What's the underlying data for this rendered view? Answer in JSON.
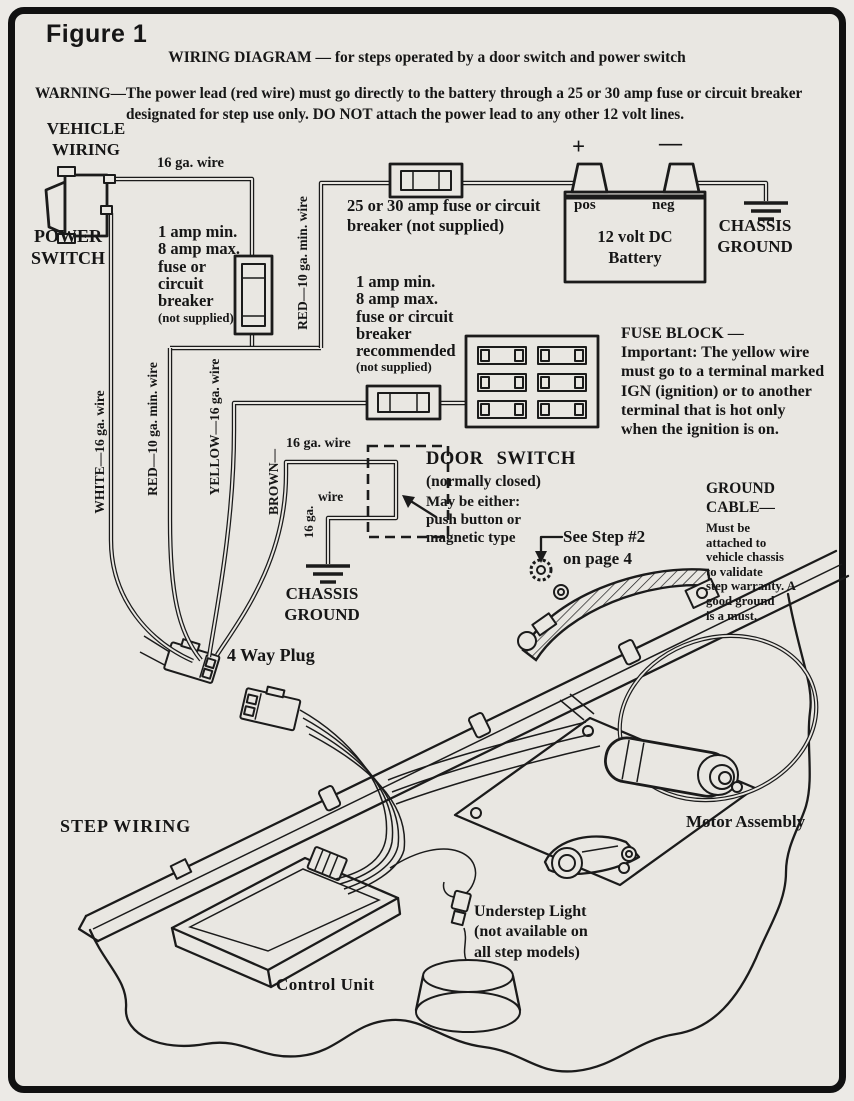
{
  "page": {
    "figure_label": "Figure 1",
    "title": "WIRING DIAGRAM — for steps operated by a door switch and power switch",
    "warning_line1": "WARNING—The power lead (red wire) must go directly to the battery through a 25 or 30 amp fuse or circuit breaker",
    "warning_line2": "designated for step use only.  DO NOT attach the power lead to any other 12 volt lines."
  },
  "vehicle_wiring": {
    "section_label": "VEHICLE\nWIRING",
    "power_switch": "POWER\nSWITCH",
    "wire_16ga_top": "16 ga. wire",
    "inline_fuse_1": {
      "spec": "1 amp min.\n8 amp max.\nfuse or\ncircuit\nbreaker",
      "note": "(not supplied)"
    },
    "red_wire_vertical": "RED—10 ga. min. wire",
    "main_fuse_label": "25 or 30 amp fuse or circuit\nbreaker (not supplied)",
    "battery": {
      "plus": "+",
      "minus": "—",
      "pos": "pos",
      "neg": "neg",
      "label": "12 volt DC\nBattery"
    },
    "chassis_ground_battery": "CHASSIS\nGROUND",
    "inline_fuse_2": {
      "spec": "1 amp min.\n8 amp max.\nfuse or circuit\nbreaker\nrecommended",
      "note": "(not supplied)"
    },
    "fuse_block_note": "FUSE BLOCK —\nImportant: The yellow wire\nmust go to a terminal marked\nIGN (ignition) or to another\nterminal that is hot only\nwhen the ignition is on.",
    "door_switch": {
      "feed_wire": "16 ga. wire",
      "title": "DOOR SWITCH",
      "subtitle": "(normally closed)",
      "description": "May be either:\npush button or\nmagnetic type",
      "ground_wire_ga": "16 ga.",
      "ground_wire_word": "wire"
    },
    "chassis_ground_door": "CHASSIS\nGROUND",
    "harness_wires": {
      "white": "WHITE—16 ga. wire",
      "red": "RED—10 ga. min. wire",
      "yellow": "YELLOW—16 ga. wire",
      "brown": "BROWN—"
    }
  },
  "step_wiring": {
    "see_step_note": "See Step #2\non page 4",
    "ground_cable": {
      "title": "GROUND\nCABLE—",
      "description": "Must be\nattached to\nvehicle chassis\nto validate\nstep warranty. A\ngood ground\nis a must."
    },
    "four_way_plug": "4 Way Plug",
    "section_label": "STEP WIRING",
    "motor_assembly": "Motor Assembly",
    "understep_light": "Understep Light\n(not available on\nall step models)",
    "control_unit": "Control Unit"
  },
  "colors": {
    "paper": "#e9e7e2",
    "ink": "#1b1b1b"
  }
}
